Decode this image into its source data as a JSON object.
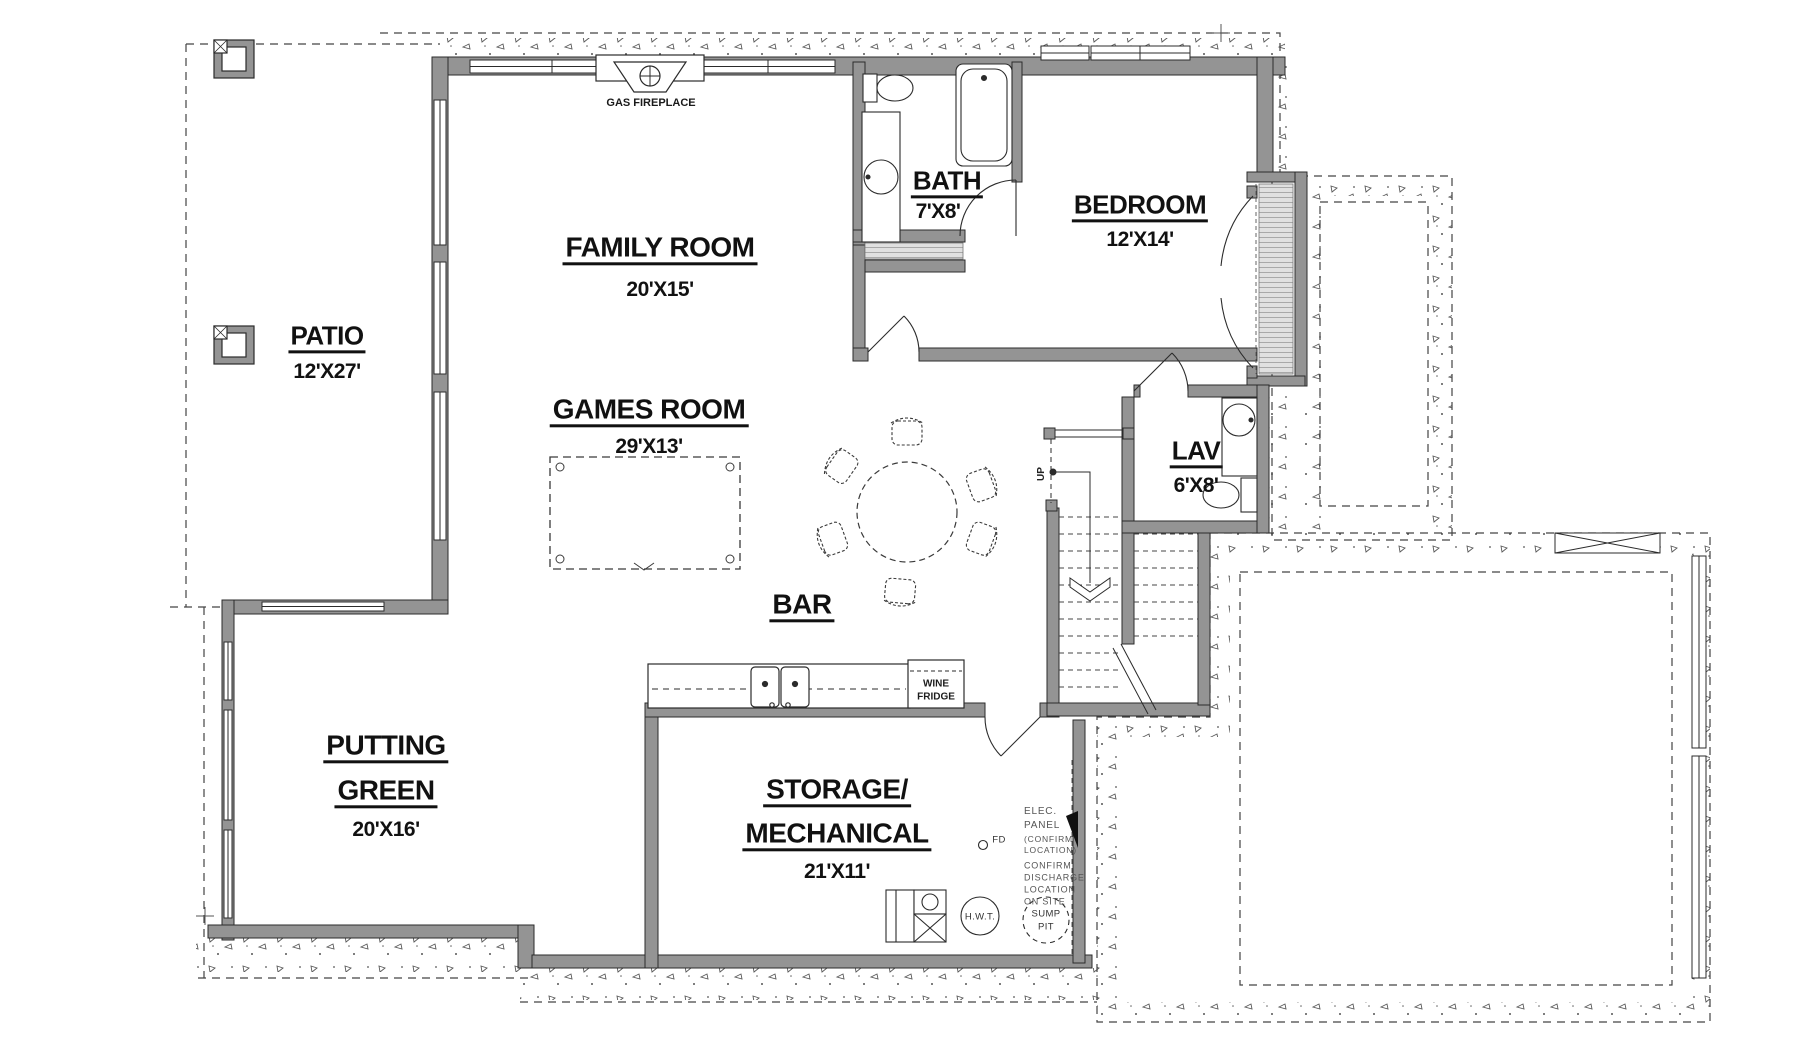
{
  "colors": {
    "wall_fill": "#949494",
    "line": "#2b2b2b",
    "note_text": "#555555",
    "label_text": "#111111"
  },
  "rooms": {
    "patio": {
      "name": "PATIO",
      "dims": "12'X27'"
    },
    "family_room": {
      "name": "FAMILY ROOM",
      "dims": "20'X15'"
    },
    "bath": {
      "name": "BATH",
      "dims": "7'X8'"
    },
    "bedroom": {
      "name": "BEDROOM",
      "dims": "12'X14'"
    },
    "games_room": {
      "name": "GAMES ROOM",
      "dims": "29'X13'"
    },
    "lav": {
      "name": "LAV",
      "dims": "6'X8'"
    },
    "bar": {
      "name": "BAR"
    },
    "putting_green": {
      "line1": "PUTTING",
      "line2": "GREEN",
      "dims": "20'X16'"
    },
    "storage": {
      "line1": "STORAGE/",
      "line2": "MECHANICAL",
      "dims": "21'X11'"
    }
  },
  "annotations": {
    "gas_fireplace": "GAS FIREPLACE",
    "wine_fridge": [
      "WINE",
      "FRIDGE"
    ],
    "up": "UP",
    "fd": "FD",
    "hwt": "H.W.T.",
    "sump": [
      "SUMP",
      "PIT"
    ],
    "elec": [
      "ELEC.",
      "PANEL",
      "(CONFIRM",
      "LOCATION)"
    ],
    "discharge": [
      "CONFIRM",
      "DISCHARGE",
      "LOCATION",
      "ON SITE"
    ]
  }
}
